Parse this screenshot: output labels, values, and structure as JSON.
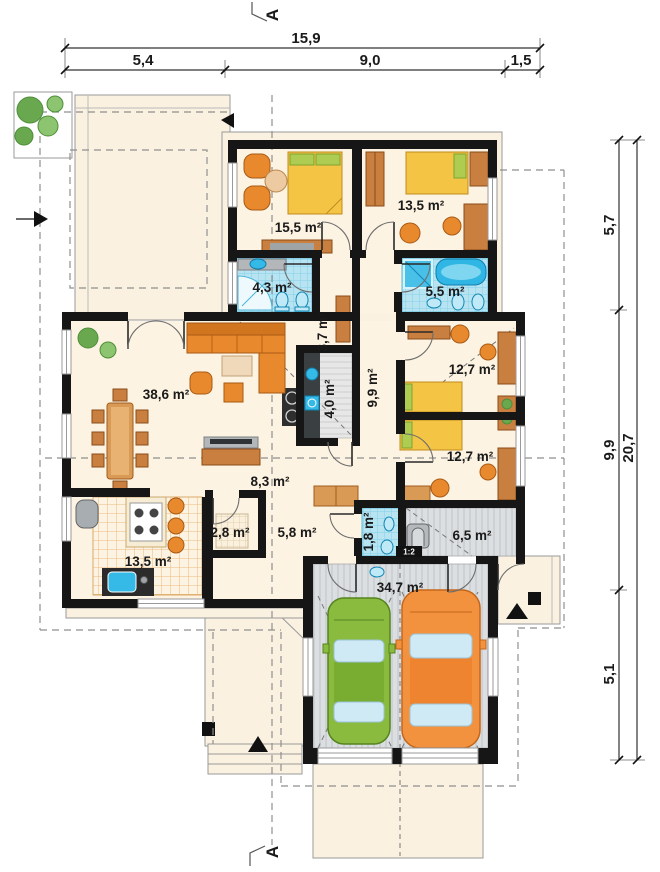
{
  "plan": {
    "section_label": "A",
    "stairs_ratio": "1:2",
    "rooms": [
      {
        "name": "bedroom-1",
        "area": "15,5 m²"
      },
      {
        "name": "bedroom-2",
        "area": "13,5 m²"
      },
      {
        "name": "bathroom-1",
        "area": "4,3 m²"
      },
      {
        "name": "bathroom-2",
        "area": "5,5 m²"
      },
      {
        "name": "wardrobe",
        "area": "3,7 m²"
      },
      {
        "name": "hallway",
        "area": "9,9 m²"
      },
      {
        "name": "utility",
        "area": "4,0 m²"
      },
      {
        "name": "living-room",
        "area": "38,6 m²"
      },
      {
        "name": "hall",
        "area": "8,3 m²"
      },
      {
        "name": "bedroom-3",
        "area": "12,7 m²"
      },
      {
        "name": "bedroom-4",
        "area": "12,7 m²"
      },
      {
        "name": "kitchen",
        "area": "13,5 m²"
      },
      {
        "name": "pantry",
        "area": "2,8 m²"
      },
      {
        "name": "corridor",
        "area": "5,8 m²"
      },
      {
        "name": "wc",
        "area": "1,8 m²"
      },
      {
        "name": "boiler-room",
        "area": "6,5 m²"
      },
      {
        "name": "garage",
        "area": "34,7 m²"
      }
    ],
    "dimensions": {
      "top_total": "15,9",
      "top_segments": [
        "5,4",
        "9,0",
        "1,5"
      ],
      "right_total": "20,7",
      "right_segments": [
        "5,7",
        "9,9",
        "5,1"
      ]
    },
    "colors": {
      "wall": "#161616",
      "floor_cream": "#fdf3e2",
      "bath_tile": "#b8e4f2",
      "furniture_orange": "#e9892e",
      "bed_yellow": "#f4c545",
      "car_green": "#8abb3f",
      "car_orange": "#f2923f",
      "garage_floor": "#dcdfe2"
    }
  }
}
